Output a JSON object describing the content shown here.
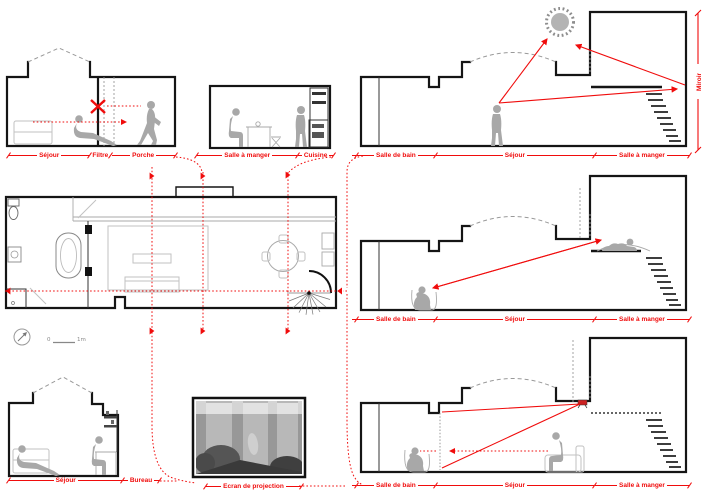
{
  "colors": {
    "annotation_red": "#f00c0c",
    "silhouette_gray": "#a8a8a8",
    "wall_black": "#151515",
    "furniture_gray": "#c2c2c2",
    "sun_gray": "#b3b3b3"
  },
  "labels": {
    "top_left": {
      "sejour": "Séjour",
      "filtre": "Filtre",
      "porche": "Porche"
    },
    "top_middle": {
      "salle_a_manger": "Salle à manger",
      "cuisine": "Cuisine"
    },
    "right_top": {
      "salle_de_bain": "Salle de bain",
      "sejour": "Séjour",
      "salle_a_manger": "Salle à manger",
      "miroir": "Miroir"
    },
    "right_middle": {
      "salle_de_bain": "Salle de bain",
      "sejour": "Séjour",
      "salle_a_manger": "Salle à manger"
    },
    "right_bottom": {
      "salle_de_bain": "Salle de bain",
      "sejour": "Séjour",
      "salle_a_manger": "Salle à manger"
    },
    "bottom_left": {
      "sejour": "Séjour",
      "bureau": "Bureau"
    },
    "projection": {
      "ecran": "Ecran de projection"
    }
  },
  "scale": {
    "zero": "0",
    "one_meter": "1m"
  }
}
